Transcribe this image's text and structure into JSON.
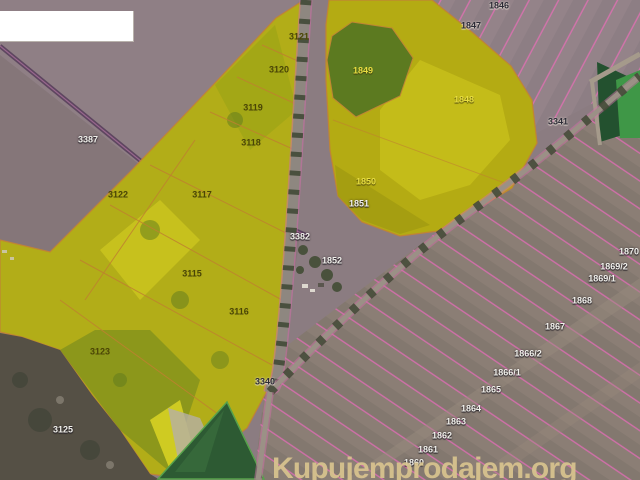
{
  "watermark": {
    "text": "Kupujemprodajem.org",
    "color": "#d9c48f"
  },
  "map": {
    "highlight_color": "#c8c01a",
    "parcel_boundary_color": "#dd76b1",
    "parcels": [
      {
        "id": "3387",
        "highlighted": false
      },
      {
        "id": "3121",
        "highlighted": true
      },
      {
        "id": "3120",
        "highlighted": true
      },
      {
        "id": "3119",
        "highlighted": true
      },
      {
        "id": "3118",
        "highlighted": true
      },
      {
        "id": "3122",
        "highlighted": true
      },
      {
        "id": "3117",
        "highlighted": true
      },
      {
        "id": "3115",
        "highlighted": true
      },
      {
        "id": "3116",
        "highlighted": true
      },
      {
        "id": "3123",
        "highlighted": true
      },
      {
        "id": "3125",
        "highlighted": false
      },
      {
        "id": "3382",
        "highlighted": false
      },
      {
        "id": "3340",
        "highlighted": false
      },
      {
        "id": "3341",
        "highlighted": false
      },
      {
        "id": "1846",
        "highlighted": false
      },
      {
        "id": "1847",
        "highlighted": false
      },
      {
        "id": "1849",
        "highlighted": true
      },
      {
        "id": "1848",
        "highlighted": true
      },
      {
        "id": "1850",
        "highlighted": true
      },
      {
        "id": "1851",
        "highlighted": false
      },
      {
        "id": "1852",
        "highlighted": false
      },
      {
        "id": "1870",
        "highlighted": false
      },
      {
        "id": "1869/2",
        "highlighted": false
      },
      {
        "id": "1869/1",
        "highlighted": false
      },
      {
        "id": "1868",
        "highlighted": false
      },
      {
        "id": "1867",
        "highlighted": false
      },
      {
        "id": "1866/2",
        "highlighted": false
      },
      {
        "id": "1866/1",
        "highlighted": false
      },
      {
        "id": "1865",
        "highlighted": false
      },
      {
        "id": "1864",
        "highlighted": false
      },
      {
        "id": "1863",
        "highlighted": false
      },
      {
        "id": "1862",
        "highlighted": false
      },
      {
        "id": "1861",
        "highlighted": false
      },
      {
        "id": "1860",
        "highlighted": false
      }
    ]
  }
}
